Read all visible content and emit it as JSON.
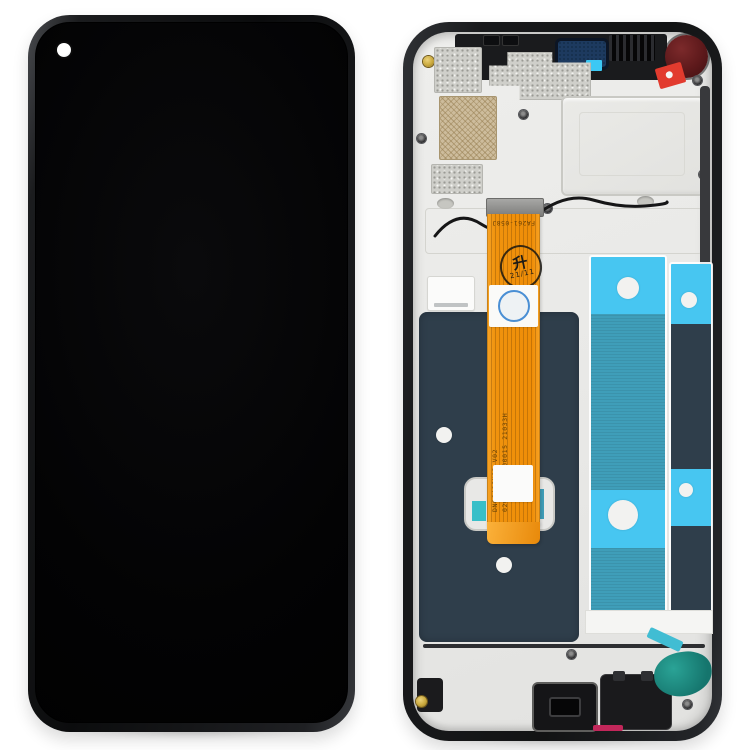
{
  "canvas": {
    "width": 750,
    "height": 750,
    "background": "#ffffff"
  },
  "front_view": {
    "screen_color": "#040405",
    "frame_highlight": "#46484c",
    "camera_hole_color": "#ffffff"
  },
  "back_view": {
    "frame_color": "#1a1b1d",
    "plate_color": "#e9e9e7",
    "lcd_back_color": "#2f3e4b",
    "adhesive_cyan": "#47c6f1",
    "adhesive_teal": "#3f9eb9",
    "adhesive_blob_teal": "#15756d",
    "earpiece_mesh_color": "#1d3a5f",
    "camera_gasket_color": "#5d191b",
    "sticker_color": "#e23b2e",
    "bottom_strip_color": "#c2275a",
    "screw_gold_color": "#c9a83c",
    "flex_cable": {
      "color": "#f0930e",
      "part_number": "FA261-058J",
      "serial_line1": "DN0649JN03  V02",
      "serial_line2": "0203-0649-00015  21033H",
      "stamp_character": "升",
      "stamp_date": "21/11"
    }
  }
}
